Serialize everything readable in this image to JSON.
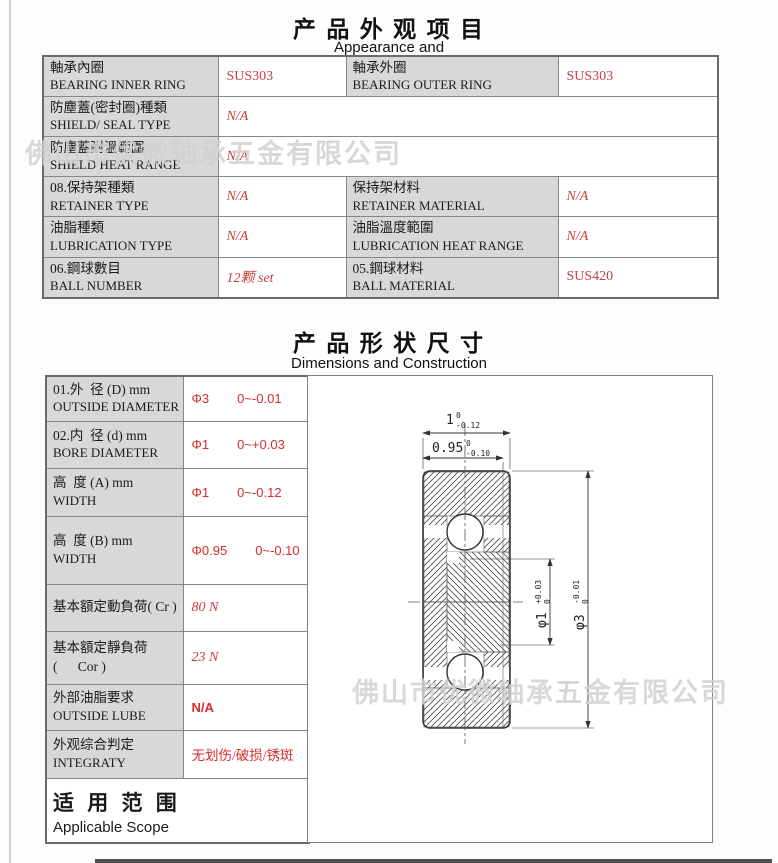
{
  "colors": {
    "value_red": "#d92b2b",
    "label_gray": "#d8d8d8",
    "border_gray": "#7a7a7a",
    "watermark_gray": "#d2d2d2",
    "drawing_ink": "#333333"
  },
  "watermark": {
    "text": "佛山市优微轴承五金有限公司"
  },
  "appearance": {
    "title": "产 品 外 观 项 目",
    "subtitle": "Appearance and",
    "rows": [
      {
        "c1zh": "軸承內圈",
        "c1en": "BEARING INNER RING",
        "v1": "SUS303",
        "c2zh": "軸承外圈",
        "c2en": "BEARING OUTER RING",
        "v2": "SUS303"
      },
      {
        "c1zh": "防塵蓋(密封圈)種類",
        "c1en": "SHIELD/ SEAL TYPE",
        "v1": "N/A"
      },
      {
        "c1zh": "防塵蓋耐溫範圍",
        "c1en": "SHIELD HEAT RANGE",
        "v1": "N/A"
      },
      {
        "c1zh": "08.保持架種類",
        "c1en": "RETAINER TYPE",
        "v1": "N/A",
        "c2zh": "保持架材料",
        "c2en": "RETAINER MATERIAL",
        "v2": "N/A"
      },
      {
        "c1zh": "油脂種類",
        "c1en": "LUBRICATION TYPE",
        "v1": "N/A",
        "c2zh": "油脂溫度範圍",
        "c2en": "LUBRICATION HEAT RANGE",
        "v2": "N/A"
      },
      {
        "c1zh": "06.鋼球數目",
        "c1en": "BALL NUMBER",
        "v1": "12颗  set",
        "c2zh": "05.鋼球材料",
        "c2en": "BALL MATERIAL",
        "v2": "SUS420"
      }
    ]
  },
  "dimensions": {
    "title": "产 品 形 状 尺 寸",
    "subtitle": "Dimensions and Construction",
    "rows": [
      {
        "zh": "01.外  径 (D) mm",
        "en": "OUTSIDE DIAMETER",
        "val": "Φ3",
        "tol": "0~-0.01"
      },
      {
        "zh": "02.内  径 (d) mm",
        "en": "BORE DIAMETER",
        "val": "Φ1",
        "tol": "0~+0.03"
      },
      {
        "zh": "高  度 (A) mm",
        "en": "WIDTH",
        "val": "Φ1",
        "tol": "0~-0.12"
      },
      {
        "zh": "高  度 (B) mm",
        "en": "WIDTH",
        "val": "Φ0.95",
        "tol": "0~-0.10"
      },
      {
        "zh": "基本額定動負荷( Cr )",
        "en": "",
        "val": "80 N",
        "tol": ""
      },
      {
        "zh": "基本額定靜負荷",
        "en": "(      Cor )",
        "val": "23 N",
        "tol": ""
      },
      {
        "zh": "外部油脂要求",
        "en": "OUTSIDE LUBE",
        "val": "N/A",
        "tol": ""
      },
      {
        "zh": "外观综合判定",
        "en": "INTEGRATY",
        "val": "无划伤/破损/锈斑",
        "tol": ""
      }
    ],
    "scope_zh": "适 用 范 围",
    "scope_en": "Applicable Scope"
  },
  "drawing": {
    "dim_width_a": {
      "main": "1",
      "sup": "0",
      "sub": "-0.12"
    },
    "dim_width_b": {
      "main": "0.95",
      "sup": "0",
      "sub": "-0.10"
    },
    "dim_bore": {
      "main": "φ1",
      "sup": "+0.03",
      "sub": "0"
    },
    "dim_outer": {
      "main": "φ3",
      "sup": "-0.01",
      "sub": "0"
    }
  }
}
